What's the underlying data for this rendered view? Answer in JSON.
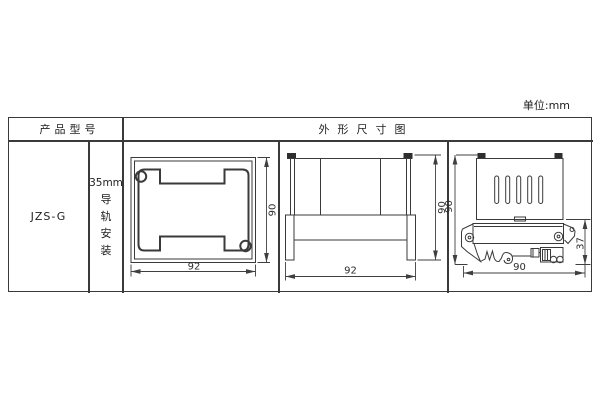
{
  "page": {
    "unit_label": "单位:mm"
  },
  "table": {
    "header": {
      "product_model": "产品型号",
      "outline_drawing": "外形尺寸图"
    },
    "body": {
      "model": "JZS-G",
      "mounting_size": "35mm",
      "mounting_chars": [
        "导",
        "轨",
        "安",
        "装"
      ]
    }
  },
  "drawings": {
    "front": {
      "width": "92",
      "height": "90"
    },
    "side": {
      "width": "92",
      "height": "90"
    },
    "rail": {
      "height": "90",
      "clip_height": "37",
      "width": "90"
    }
  }
}
